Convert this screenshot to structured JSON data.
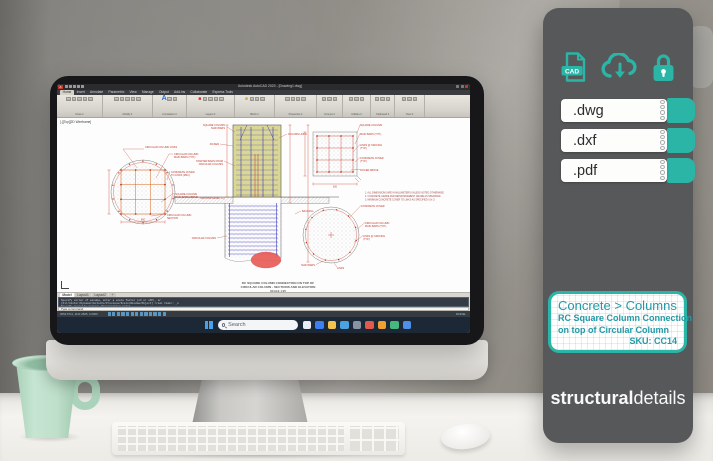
{
  "panel": {
    "colors": {
      "teal": "#2ab5a6",
      "panel_bg": "#57585a"
    },
    "cad_badge": "CAD",
    "formats": [
      {
        "id": "dwg",
        "label": ".dwg"
      },
      {
        "id": "dxf",
        "label": ".dxf"
      },
      {
        "id": "pdf",
        "label": ".pdf"
      }
    ],
    "product": {
      "category": "Concrete > Columns",
      "line1": "RC Square Column Connection",
      "line2": "on top of Circular Column",
      "sku": "SKU: CC14"
    },
    "brand": {
      "bold": "structural",
      "regular": "details"
    }
  },
  "autocad": {
    "app_badge": "A",
    "titlebar_title": "Autodesk AutoCAD 2023 - [Drawing1.dwg]",
    "ribbon_tabs": [
      "Home",
      "Insert",
      "Annotate",
      "Parametric",
      "View",
      "Manage",
      "Output",
      "Add-ins",
      "Collaborate",
      "Express Tools"
    ],
    "ribbon_groups": [
      "Draw",
      "Modify",
      "Annotation",
      "Layers",
      "Block",
      "Properties",
      "Groups",
      "Utilities",
      "Clipboard",
      "View"
    ],
    "viewport_controls": "[-][Top][2D Wireframe]",
    "layout_tabs": [
      "Model",
      "Layout1",
      "Layout2",
      "+"
    ],
    "command_lines": [
      "Specify corner of window, enter a scale factor (nX or nXP), or",
      "[All/Center/Dynamic/Extents/Previous/Scale/Window/Object] <real time>: _e",
      "Specify opposite corner: Regenerating model."
    ],
    "command_input": "Type a command",
    "statusbar_coords": "3054.6711, 1121.0825, 0.0000",
    "statusbar_mode": "MODEL",
    "taskbar": {
      "search_label": "Search",
      "icons": [
        {
          "name": "widgets-icon",
          "color": "#e8eef4"
        },
        {
          "name": "edge-browser-icon",
          "color": "#3d7ef0"
        },
        {
          "name": "file-explorer-icon",
          "color": "#f2c14e"
        },
        {
          "name": "microsoft-store-icon",
          "color": "#4aa3e0"
        },
        {
          "name": "settings-icon",
          "color": "#8a93a3"
        },
        {
          "name": "autocad-app-icon",
          "color": "#e05a4e"
        },
        {
          "name": "office-icon",
          "color": "#f0a030"
        },
        {
          "name": "excel-icon",
          "color": "#46b87f"
        },
        {
          "name": "outlook-icon",
          "color": "#4f8fe8"
        }
      ]
    }
  },
  "drawing": {
    "labels": [
      {
        "x": 88,
        "y": 30,
        "anchor": "start",
        "lines": [
          "CIRCULAR COLUMN LINKS"
        ]
      },
      {
        "x": 117,
        "y": 37,
        "anchor": "start",
        "lines": [
          "CIRCULAR COLUMN",
          "MAIN BARS (TYP.)"
        ]
      },
      {
        "x": 114,
        "y": 55,
        "anchor": "start",
        "lines": [
          "CONCRETE COVER",
          "TO LINKS (MIN.)"
        ]
      },
      {
        "x": 118,
        "y": 77,
        "anchor": "start",
        "lines": [
          "SQUARE COLUMN",
          "MAIN BARS ABOVE"
        ]
      },
      {
        "x": 110,
        "y": 98,
        "anchor": "start",
        "lines": [
          "CIRCULAR COLUMN",
          "SECTION"
        ]
      },
      {
        "x": 168,
        "y": 8,
        "anchor": "end",
        "lines": [
          "SQUARE COLUMN",
          "MAIN BARS"
        ]
      },
      {
        "x": 162,
        "y": 27,
        "anchor": "end",
        "lines": [
          "KICKER"
        ]
      },
      {
        "x": 166,
        "y": 44,
        "anchor": "end",
        "lines": [
          "STARTER BARS FROM",
          "CIRCULAR COLUMN"
        ]
      },
      {
        "x": 163,
        "y": 81,
        "anchor": "end",
        "lines": [
          "GROUND LEVEL"
        ]
      },
      {
        "x": 231,
        "y": 17,
        "anchor": "start",
        "lines": [
          "COLUMN LINKS"
        ]
      },
      {
        "x": 245,
        "y": 94,
        "anchor": "start",
        "lines": [
          "BACKFILL"
        ]
      },
      {
        "x": 159,
        "y": 121,
        "anchor": "end",
        "lines": [
          "CIRCULAR COLUMN"
        ]
      },
      {
        "x": 303,
        "y": 8,
        "anchor": "start",
        "lines": [
          "SQUARE COLUMN"
        ]
      },
      {
        "x": 303,
        "y": 17,
        "anchor": "start",
        "lines": [
          "MAIN BARS (TYP.)"
        ]
      },
      {
        "x": 303,
        "y": 28,
        "anchor": "start",
        "lines": [
          "LINKS @ SPACING",
          "(TYP.)"
        ]
      },
      {
        "x": 303,
        "y": 41,
        "anchor": "start",
        "lines": [
          "CONCRETE COVER",
          "(TYP.)"
        ]
      },
      {
        "x": 303,
        "y": 53,
        "anchor": "start",
        "lines": [
          "KICKER ABOVE"
        ]
      },
      {
        "x": 304,
        "y": 89,
        "anchor": "start",
        "lines": [
          "CONCRETE COVER"
        ]
      },
      {
        "x": 308,
        "y": 106,
        "anchor": "start",
        "lines": [
          "CIRCULAR COLUMN",
          "MAIN BARS (TYP.)"
        ]
      },
      {
        "x": 306,
        "y": 119,
        "anchor": "start",
        "lines": [
          "LINKS @ SPACING",
          "(TYP.)"
        ]
      },
      {
        "x": 258,
        "y": 148,
        "anchor": "end",
        "lines": [
          "MAIN BARS"
        ]
      },
      {
        "x": 280,
        "y": 151,
        "anchor": "start",
        "lines": [
          "LINKS"
        ]
      },
      {
        "x": 86,
        "y": 102.5,
        "anchor": "middle",
        "lines": [
          "600"
        ]
      },
      {
        "x": 278,
        "y": 69.5,
        "anchor": "middle",
        "lines": [
          "300"
        ]
      }
    ],
    "notes": [
      "1. ALL DIMENSIONS ARE IN MILLIMETERS UNLESS NOTED OTHERWISE.",
      "2. CONCRETE GRADE AND REINFORCEMENT GRADE AS SPECIFIED.",
      "3. MINIMUM CONCRETE COVER TO LINKS AS SPECIFIED U.N.O."
    ],
    "title_lines": [
      "RC SQUARE COLUMN CONNECTION ON TOP OF",
      "CIRCULAR COLUMN - SECTIONS AND ELEVATION",
      "SCALE 1:25"
    ]
  }
}
